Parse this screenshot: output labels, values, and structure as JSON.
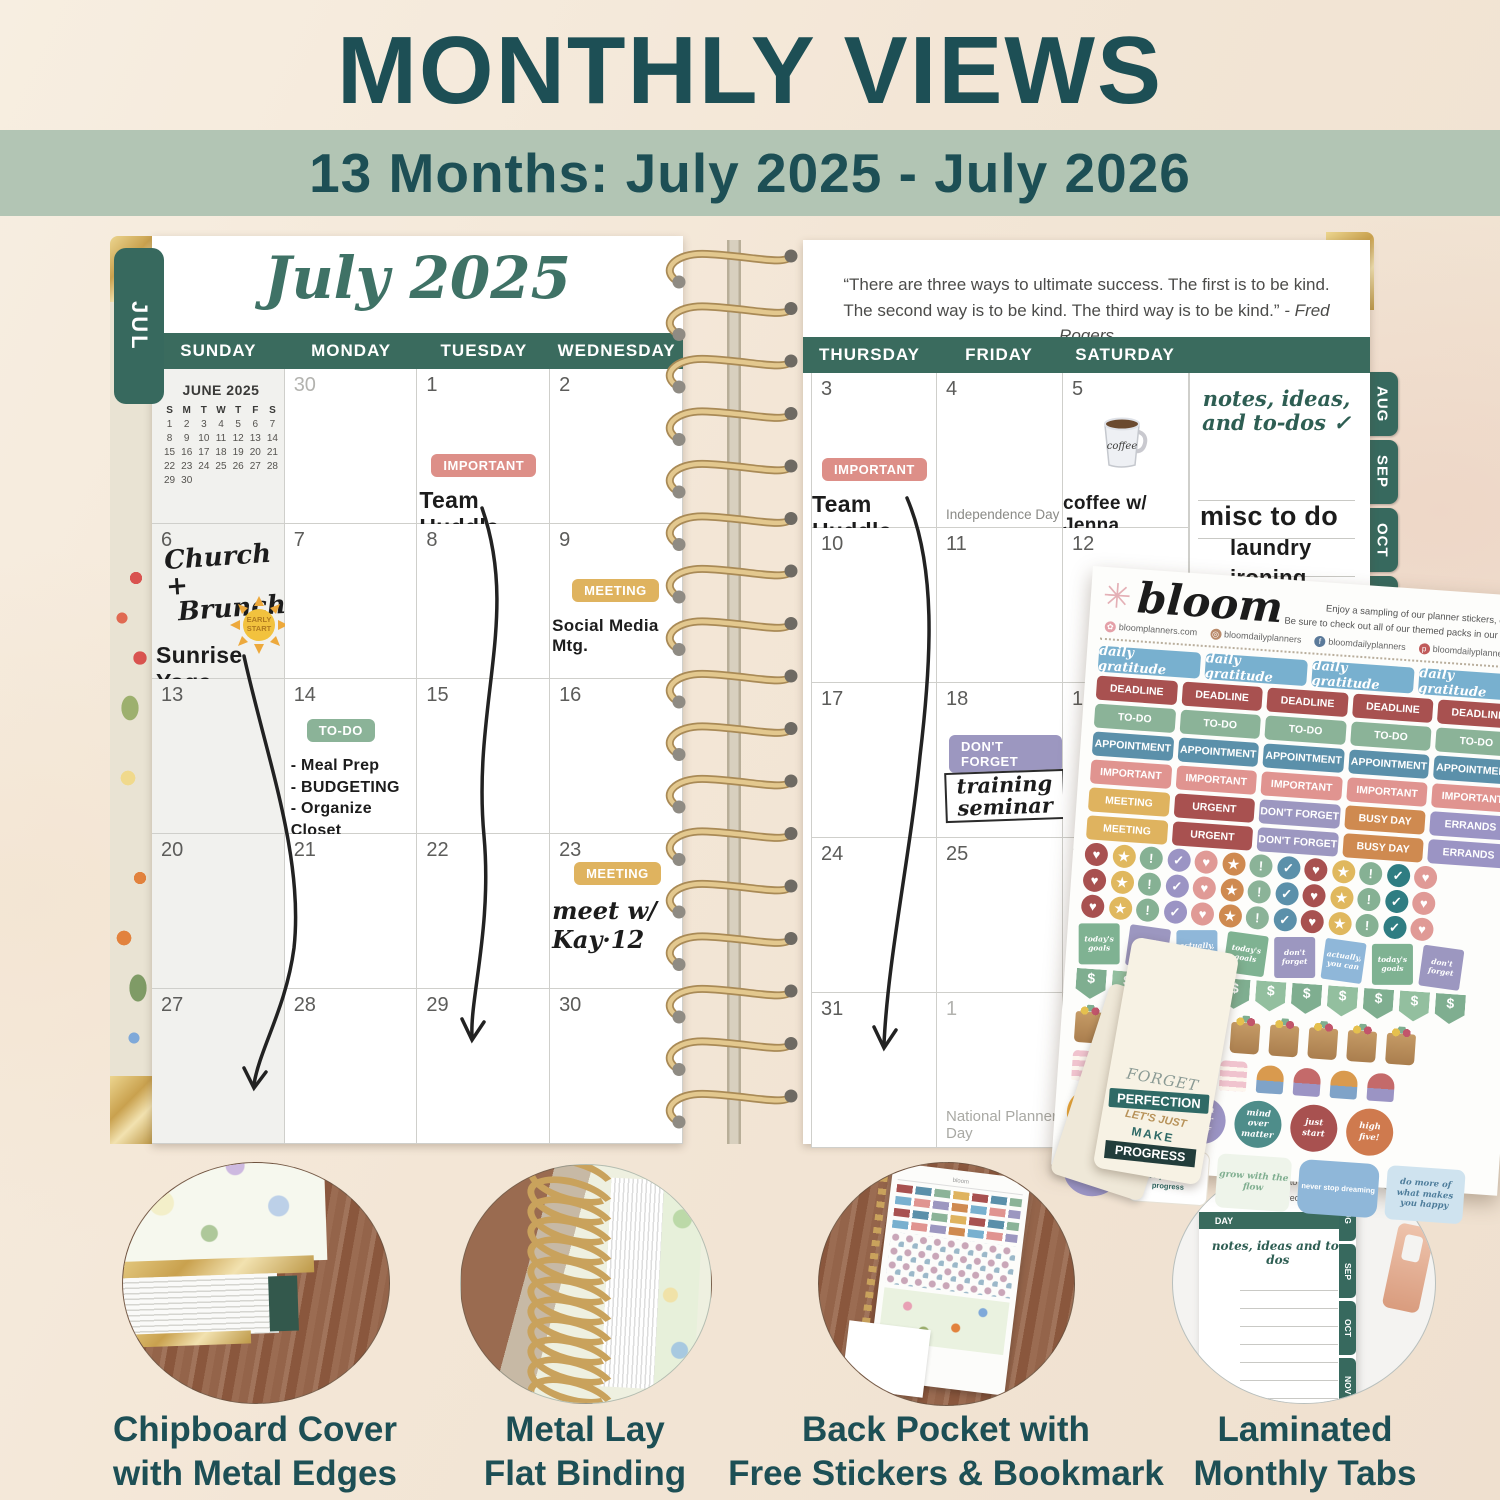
{
  "header": {
    "title": "MONTHLY VIEWS",
    "subtitle": "13 Months: July 2025 - July 2026"
  },
  "colors": {
    "brand_teal": "#1d4f55",
    "band_teal": "#3a6b5e",
    "sage_band": "#b2c5b4",
    "cream_bg": "#f4e9dc",
    "gold": "#d9b878",
    "important_pink": "#dd8f88",
    "meeting_yellow": "#dfb35f",
    "todo_green": "#8bb398",
    "dontforget_purple": "#9c97c0",
    "gratitude_blue": "#78b0cf",
    "deadline_maroon": "#a85150",
    "appointment_blue": "#5b90aa",
    "busyday_orange": "#cf8a50",
    "errands_lavender": "#9b94c4"
  },
  "planner": {
    "left_tab": "JUL",
    "right_tabs": [
      "AUG",
      "SEP",
      "OCT",
      "NOV"
    ],
    "month_title": "July 2025",
    "quote_line1": "“There are three ways to ultimate success. The first is to be kind.",
    "quote_line2": "The second way is to be kind. The third way is to be kind.”",
    "quote_attribution": " - Fred Rogers",
    "day_headers_left": [
      "SUNDAY",
      "MONDAY",
      "TUESDAY",
      "WEDNESDAY"
    ],
    "day_headers_right": [
      "THURSDAY",
      "FRIDAY",
      "SATURDAY"
    ],
    "left_dates": [
      [
        "",
        "30",
        "1",
        "2"
      ],
      [
        "6",
        "7",
        "8",
        "9"
      ],
      [
        "13",
        "14",
        "15",
        "16"
      ],
      [
        "20",
        "21",
        "22",
        "23"
      ],
      [
        "27",
        "28",
        "29",
        "30"
      ]
    ],
    "right_dates": [
      [
        "3",
        "4",
        "5"
      ],
      [
        "10",
        "11",
        "12"
      ],
      [
        "17",
        "18",
        "19"
      ],
      [
        "24",
        "25",
        "26"
      ],
      [
        "31",
        "1",
        ""
      ]
    ],
    "mini_june": {
      "title": "JUNE 2025",
      "dow": [
        "S",
        "M",
        "T",
        "W",
        "T",
        "F",
        "S"
      ],
      "start_offset": 0,
      "days_in_month": 30
    },
    "mini_august": {
      "title": "AUGUST 2025",
      "dow": [
        "S",
        "M",
        "T",
        "W",
        "T",
        "F",
        "S"
      ],
      "start_offset": 5,
      "days_in_month": 31
    },
    "notes_panel": {
      "heading1": "notes, ideas,",
      "heading2": "and to-dos ✓",
      "entry1": "misc to do",
      "entry2": "laundry",
      "entry3": "ironing"
    },
    "entries": {
      "jul1": {
        "badge": "IMPORTANT",
        "note": "Team Huddle"
      },
      "jul3": {
        "badge": "IMPORTANT",
        "note": "Team Huddle"
      },
      "jul4": {
        "holiday": "Independence Day"
      },
      "jul5": {
        "mug_text": "coffee",
        "note": "coffee w/ Jenna"
      },
      "jul6": {
        "script1": "Church +",
        "script2": "Brunch",
        "sun_sticker": "EARLY START",
        "note": "Sunrise Yoga"
      },
      "jul9": {
        "badge": "MEETING",
        "note": "Social Media Mtg."
      },
      "jul14": {
        "badge": "TO-DO",
        "item1": "- Meal Prep",
        "item2": "- BUDGETING",
        "item3": "- Organize Closet"
      },
      "jul18": {
        "badge": "DON'T FORGET",
        "note1": "training",
        "note2": "seminar"
      },
      "jul23": {
        "badge": "MEETING",
        "note": "meet w/ Kay·12"
      },
      "aug1": {
        "holiday": "National Planner Day"
      }
    }
  },
  "sticker_sheet": {
    "brand": "bloom",
    "flower_icon": "✳",
    "tagline1": "Enjoy a sampling of our planner stickers, on us!",
    "tagline2": "Be sure to check out all of our themed packs in our store.",
    "links": [
      {
        "icon": "flower-icon",
        "text": "bloomplanners.com"
      },
      {
        "icon": "instagram-icon",
        "text": "bloomdailyplanners"
      },
      {
        "icon": "facebook-icon",
        "text": "bloomdailyplanners"
      },
      {
        "icon": "pinterest-icon",
        "text": "bloomdailyplanners"
      }
    ],
    "gratitude_label": "daily gratitude",
    "row_deadline": "DEADLINE",
    "row_todo": "TO-DO",
    "row_appointment": "APPOINTMENT",
    "row_important": "IMPORTANT",
    "mixed_row": [
      "MEETING",
      "URGENT",
      "DON'T FORGET",
      "BUSY DAY",
      "ERRANDS"
    ],
    "mixed_colors": [
      "#dfb35f",
      "#a85150",
      "#9c97c0",
      "#cf8a50",
      "#9b94c4"
    ],
    "dots_row": [
      {
        "sym": "♥",
        "c": "#a85150"
      },
      {
        "sym": "★",
        "c": "#e0b85e"
      },
      {
        "sym": "!",
        "c": "#86b194"
      },
      {
        "sym": "✓",
        "c": "#9b94c4"
      },
      {
        "sym": "♥",
        "c": "#e09a96"
      },
      {
        "sym": "★",
        "c": "#cf8a50"
      },
      {
        "sym": "!",
        "c": "#8bb398"
      },
      {
        "sym": "✓",
        "c": "#5b90aa"
      },
      {
        "sym": "♥",
        "c": "#a85150"
      },
      {
        "sym": "★",
        "c": "#e0b85e"
      },
      {
        "sym": "!",
        "c": "#86b194"
      },
      {
        "sym": "✓",
        "c": "#2f7d82"
      },
      {
        "sym": "♥",
        "c": "#e09a96"
      }
    ],
    "sticky_notes": [
      {
        "text": "today's goals",
        "c": "#7fb292"
      },
      {
        "text": "don't forget",
        "c": "#9c97c0"
      },
      {
        "text": "actually, you can",
        "c": "#8fb7d9"
      }
    ],
    "flag_symbol": "$",
    "round_push": "push your self",
    "round_mind": "mind over matter",
    "round_start": "just start",
    "round_five": "high five!",
    "quote_progress": "forget perfection, let's just make progress",
    "quote_grow": "grow with the flow",
    "quote_dream": "never stop dreaming",
    "quote_happy": "do more of what makes you happy"
  },
  "bookmark": {
    "line1": "FORGET",
    "line2": "PERFECTION",
    "line3": "LET'S JUST",
    "line4": "MAKE",
    "line5": "PROGRESS"
  },
  "features": [
    {
      "line1": "Chipboard Cover",
      "line2": "with Metal Edges"
    },
    {
      "line1": "Metal Lay",
      "line2": "Flat Binding"
    },
    {
      "line1": "Back Pocket with",
      "line2": "Free Stickers & Bookmark"
    },
    {
      "line1": "Laminated",
      "line2": "Monthly Tabs"
    }
  ],
  "feature4_detail": {
    "frag1": "first is to be kind.",
    "frag2": "be kind.” - Fred Rogers",
    "band": "DAY",
    "script": "notes, ideas and to-dos",
    "tabs": [
      "AUG",
      "SEP",
      "OCT",
      "NOV"
    ]
  }
}
